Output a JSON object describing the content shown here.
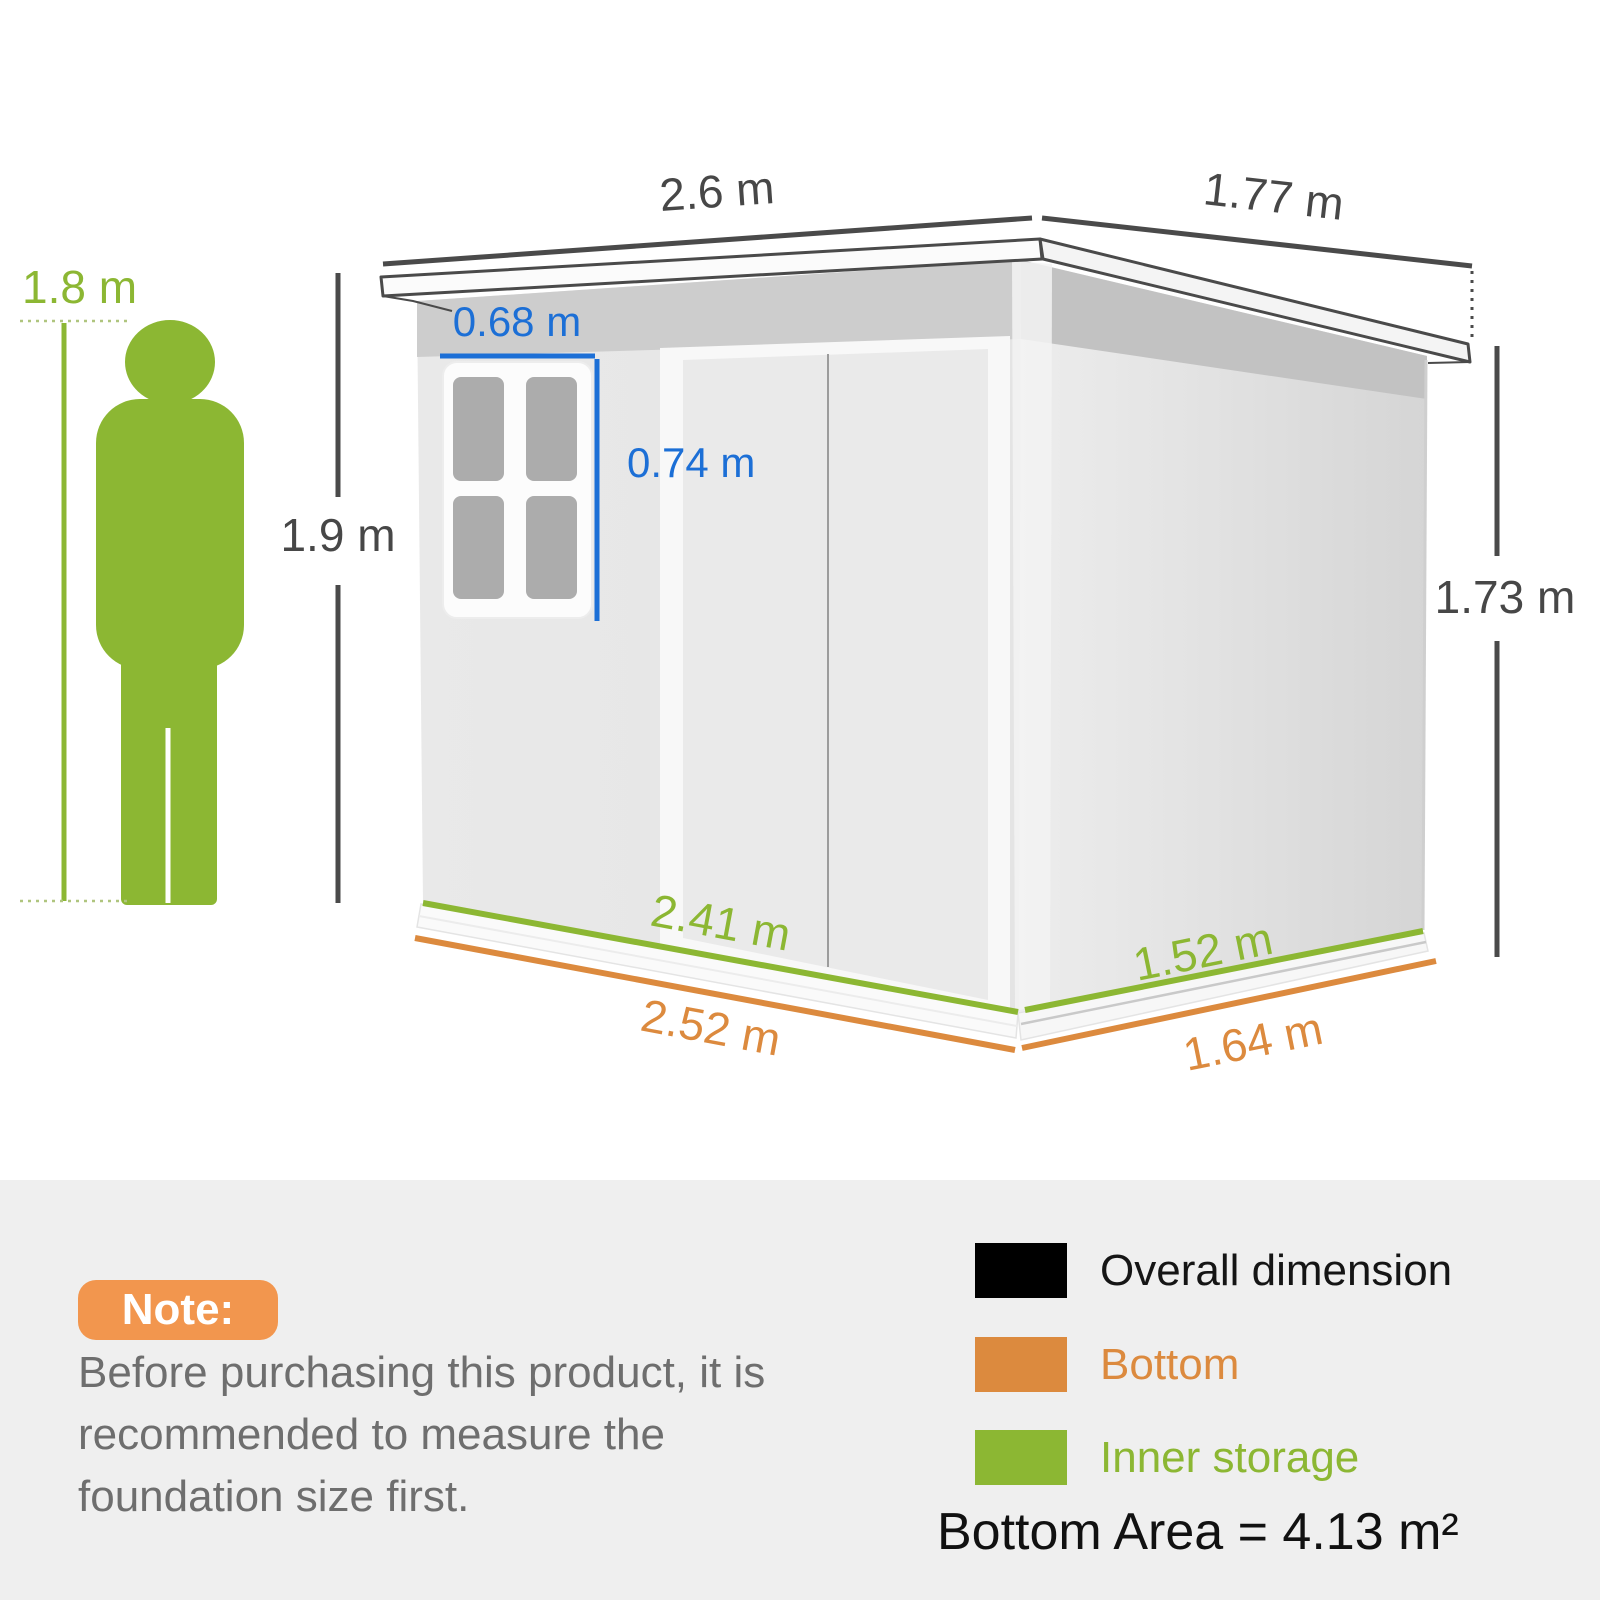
{
  "figure": {
    "person_height": "1.8 m",
    "dimensions": {
      "roof_width": "2.6 m",
      "roof_depth": "1.77 m",
      "front_height": "1.9 m",
      "rear_height": "1.73 m",
      "window_width": "0.68 m",
      "window_height": "0.74 m",
      "inner_width": "2.41 m",
      "inner_depth": "1.52 m",
      "bottom_width": "2.52 m",
      "bottom_depth": "1.64 m"
    },
    "colors": {
      "overall_dimension": "#000000",
      "bottom": "#DC8A3E",
      "inner_storage": "#8CB733",
      "window_dimension": "#1C6FD6",
      "person": "#8CB733"
    }
  },
  "note": {
    "badge": "Note:",
    "body": "Before purchasing this product, it is recommended to measure the foundation size first."
  },
  "legend": [
    {
      "label": "Overall dimension",
      "color": "#000000"
    },
    {
      "label": "Bottom",
      "color": "#DC8A3E"
    },
    {
      "label": "Inner storage",
      "color": "#8CB733"
    }
  ],
  "bottom_area": "Bottom Area = 4.13 m²"
}
